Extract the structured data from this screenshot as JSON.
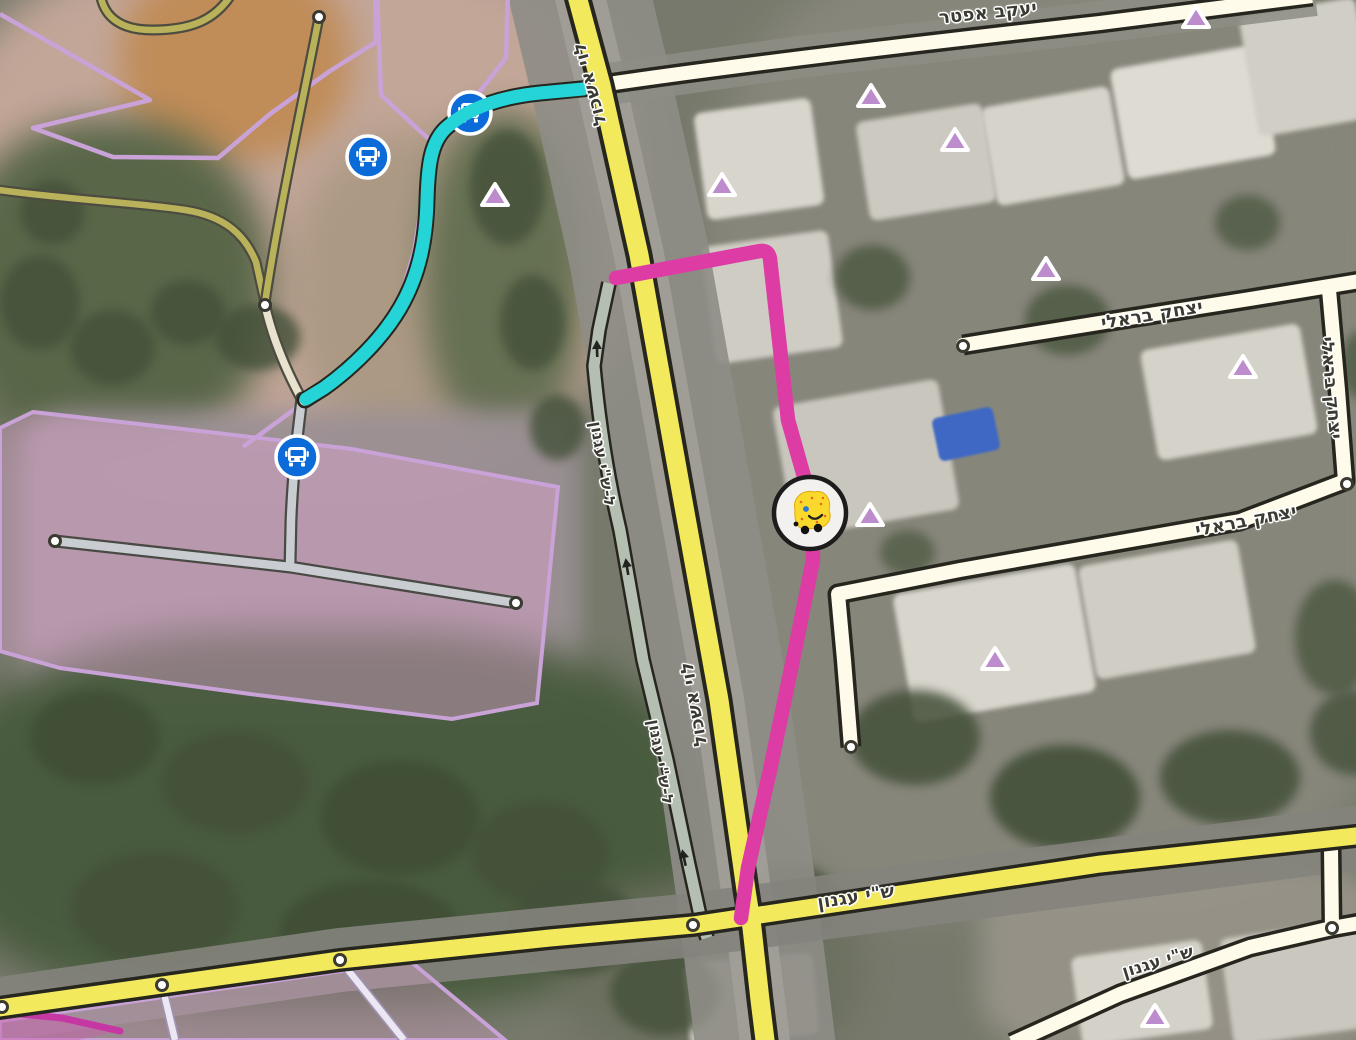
{
  "map": {
    "view_mode": "satellite",
    "language": "hebrew"
  },
  "colors": {
    "route_navigation": "#dc3ca3",
    "route_highlight": "#24d4d6",
    "primary_road_fill": "#f2e95c",
    "street_road_fill": "#fffbea",
    "ramp_road_fill": "#b4bfb1",
    "path_fill": "#b9b25b",
    "path_casing": "#4c4c40",
    "road_casing": "#26261f",
    "parking_road_fill": "#c9cdd2",
    "landuse_fill": "rgba(226,168,212,0.42)",
    "landuse_border": "#c9a2d8",
    "landuse_border_strong": "#c538a3",
    "marker_fill": "#bd8ccc",
    "bus_icon_bg": "#0a6bd9",
    "mood_face": "#fbd92c",
    "label_color": "#3b3b33"
  },
  "road_labels": [
    {
      "id": "yaakov-apter",
      "text": "יעקב אפטר"
    },
    {
      "id": "yitzhak-bareli-upper",
      "text": "יצחק בראלי"
    },
    {
      "id": "yitzhak-bareli-vertical",
      "text": "יצחק בראלי"
    },
    {
      "id": "yitzhak-bareli-lower",
      "text": "יצחק בראלי"
    },
    {
      "id": "levi-eshkol-top",
      "text": "לוי אשכול"
    },
    {
      "id": "levi-eshkol-mid",
      "text": "לוי אשכול"
    },
    {
      "id": "to-shai-agnon-upper",
      "text": "ל-ש\"י עגנון"
    },
    {
      "id": "to-shai-agnon-lower",
      "text": "ל-ש\"י עגנון"
    },
    {
      "id": "shai-agnon-primary",
      "text": "ש\"י עגנון"
    },
    {
      "id": "shai-agnon-white",
      "text": "ש\"י עגנון"
    }
  ],
  "markers": {
    "bus_stops": {
      "icon": "bus-front",
      "count": 3,
      "positions": [
        {
          "x": 368,
          "y": 157
        },
        {
          "x": 470,
          "y": 113
        },
        {
          "x": 297,
          "y": 457
        }
      ]
    },
    "places": {
      "icon": "triangle",
      "count": 10,
      "positions": [
        {
          "x": 495,
          "y": 196
        },
        {
          "x": 722,
          "y": 186
        },
        {
          "x": 871,
          "y": 97
        },
        {
          "x": 955,
          "y": 141
        },
        {
          "x": 1046,
          "y": 270
        },
        {
          "x": 1196,
          "y": 18
        },
        {
          "x": 1243,
          "y": 368
        },
        {
          "x": 870,
          "y": 516
        },
        {
          "x": 995,
          "y": 660
        },
        {
          "x": 1155,
          "y": 1017
        }
      ]
    },
    "user": {
      "icon": "waze-mood-face",
      "x": 810,
      "y": 513
    }
  },
  "junction_nodes": {
    "count": 12,
    "positions": [
      {
        "x": 319,
        "y": 17
      },
      {
        "x": 265,
        "y": 305
      },
      {
        "x": 55,
        "y": 541
      },
      {
        "x": 516,
        "y": 603
      },
      {
        "x": 963,
        "y": 346
      },
      {
        "x": 1347,
        "y": 484
      },
      {
        "x": 851,
        "y": 747
      },
      {
        "x": 2,
        "y": 1007
      },
      {
        "x": 162,
        "y": 985
      },
      {
        "x": 340,
        "y": 960
      },
      {
        "x": 693,
        "y": 925
      },
      {
        "x": 1332,
        "y": 928
      }
    ]
  }
}
